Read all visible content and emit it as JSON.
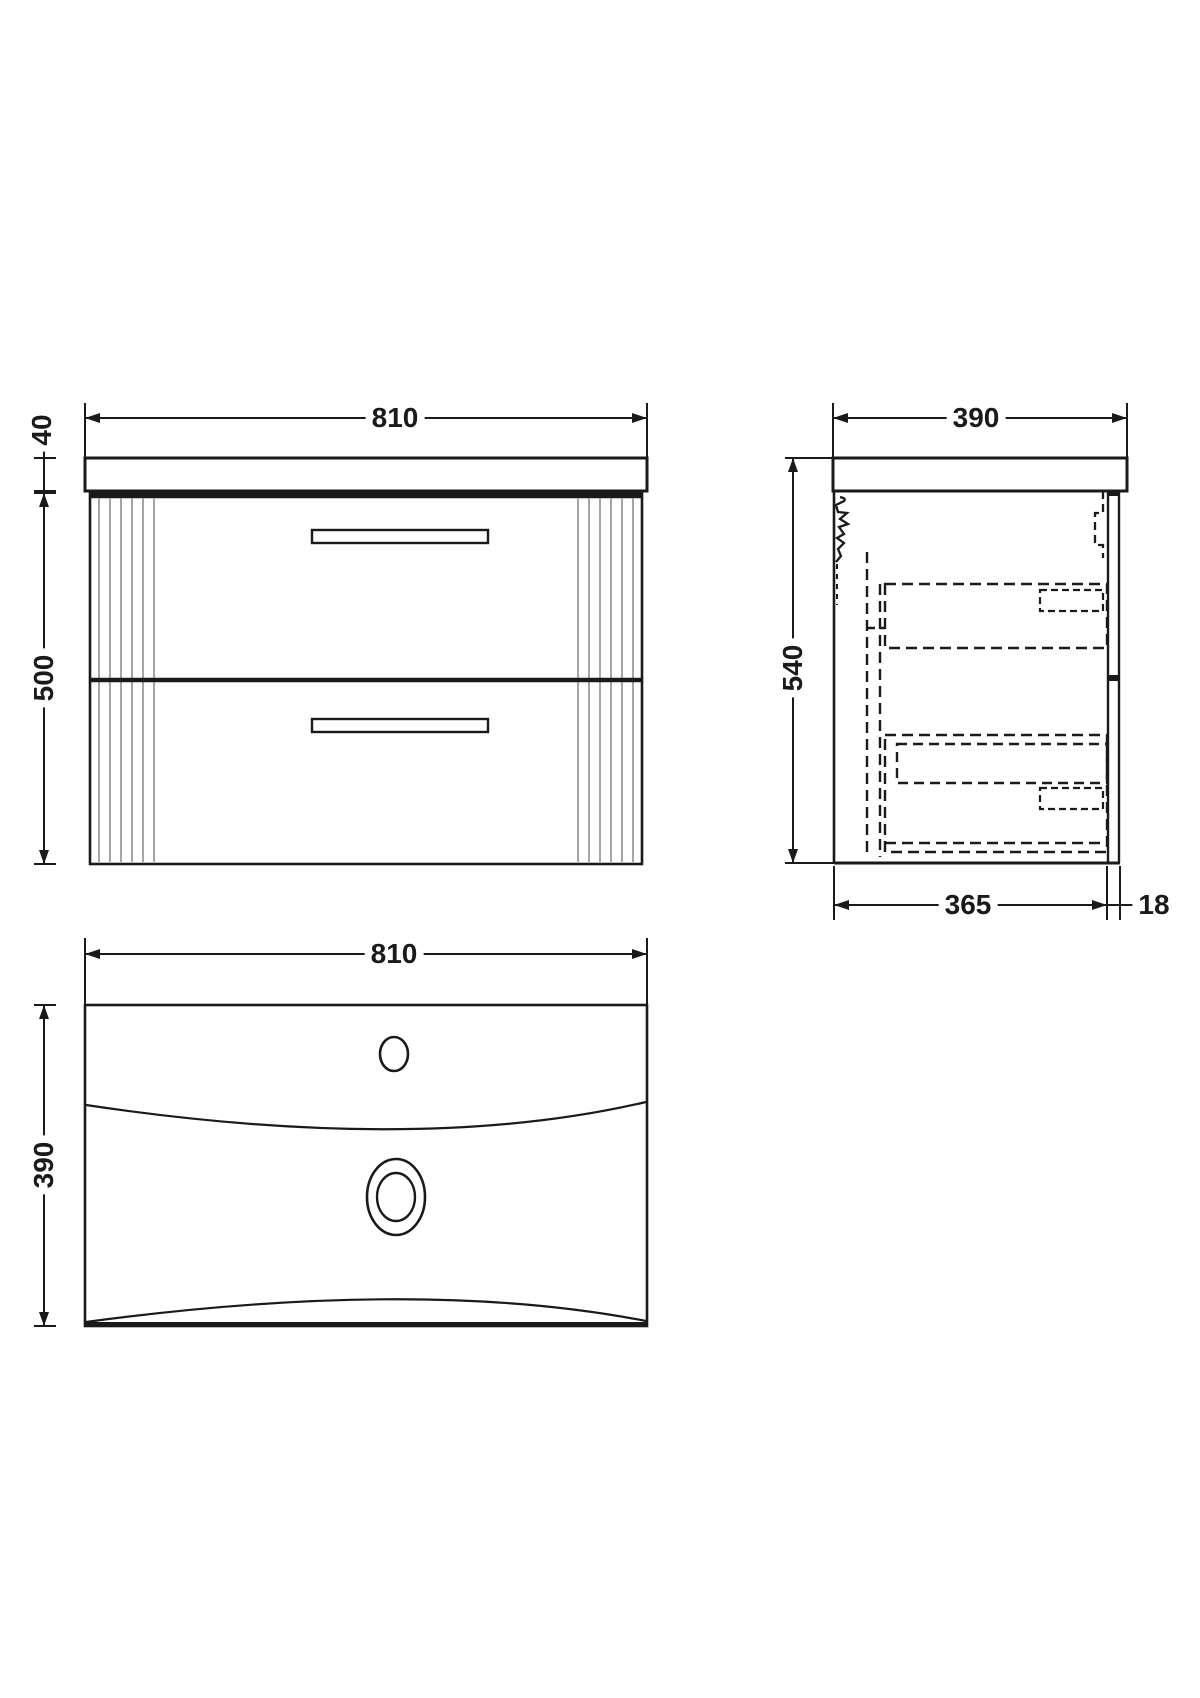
{
  "drawing_title": "wall-hung vanity unit with basin - dimension drawing",
  "views": {
    "front": {
      "width": "810",
      "counter_thickness": "40",
      "cabinet_height": "500"
    },
    "side": {
      "depth": "390",
      "overall_height": "540",
      "body_depth": "365",
      "back_panel_thickness": "18"
    },
    "basin": {
      "width": "810",
      "depth": "390"
    }
  },
  "colors": {
    "line": "#1a1a1a",
    "flute": "#9b9b9b",
    "background": "#ffffff"
  }
}
